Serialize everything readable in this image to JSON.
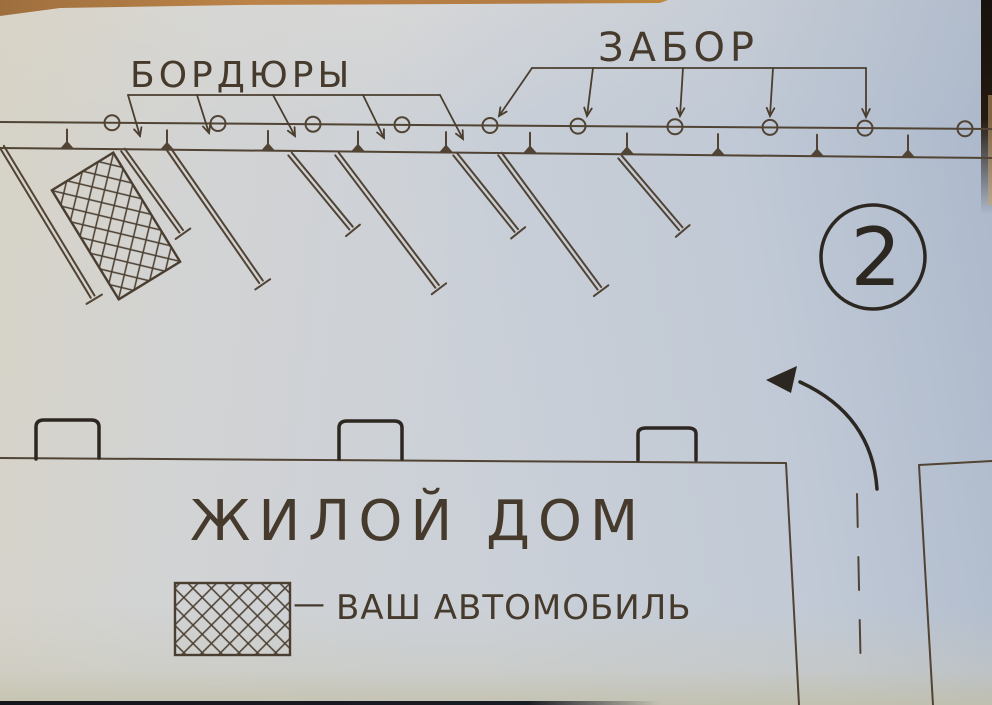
{
  "scheme_number": "2",
  "labels": {
    "curbs": "БОРДЮРЫ",
    "fence": "ЗАБОР",
    "house": "ЖИЛОЙ ДОМ"
  },
  "legend": {
    "dash": "—",
    "car_label": "ВАШ АВТОМОБИЛЬ",
    "symbol": "crosshatched-rectangle"
  },
  "counts": {
    "fence_posts": 10,
    "curb_sections": 10,
    "parking_dividers": 8,
    "house_porches": 3
  },
  "colors": {
    "paper": "#cfd3d9",
    "ink": "#514434",
    "ink_bold": "#2d2721",
    "wood": "#b5804a"
  }
}
